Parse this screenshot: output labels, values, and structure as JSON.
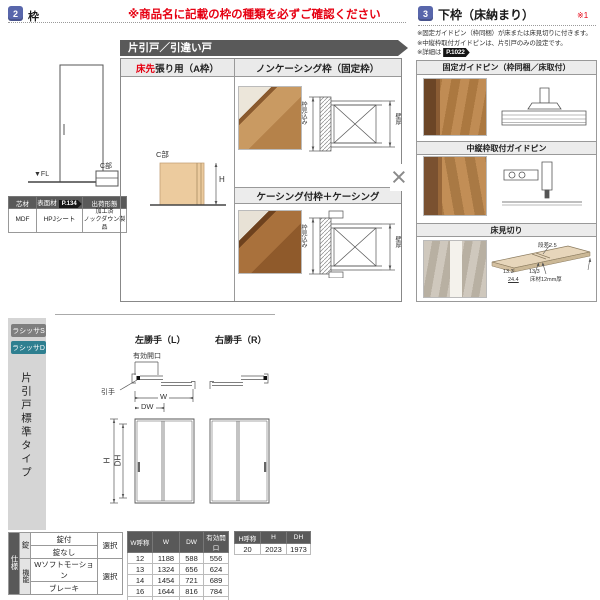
{
  "colors": {
    "accent_blue": "#5866ab",
    "alert_red": "#e60012",
    "teal_tab": "#2e7f90",
    "dark_gray": "#595959"
  },
  "frame_section": {
    "badge": "2",
    "title": "枠",
    "warning": "※商品名に記載の枠の種類を必ずご確認ください",
    "fl": "▼FL",
    "c_part": "C部",
    "material_table": {
      "headers": [
        "芯材",
        "表面材",
        "出荷形態"
      ],
      "page_badge": "P.134",
      "values": [
        "MDF",
        "HPJシート",
        "加工済\nノックダウン製品"
      ]
    },
    "door_types_banner": "片引戸／引違い戸",
    "floor_first_red": "床先",
    "floor_first_rest": "張り用（A枠）",
    "noncasing_header": "ノンケーシング枠（固定枠）",
    "casing_header": "ケーシング付枠＋ケーシング",
    "h_dim": "H",
    "frame_depth_dim": "枠見込み",
    "wall_thickness_dim": "壁厚",
    "times_mark": "×"
  },
  "bottom_rail_section": {
    "badge": "3",
    "title": "下枠（床納まり）",
    "ref_mark": "※1",
    "notes": [
      "※固定ガイドピン（枠同梱）が床または床見切りに付きます。",
      "※中縦枠取付ガイドピンは、片引戸のみの設定です。",
      "※詳細は"
    ],
    "page_badge": "P.1022",
    "fixed_pin_header": "固定ガイドピン（枠同梱／床取付）",
    "mid_frame_pin_header": "中縦枠取付ガイドピン",
    "floor_edge_header": "床見切り",
    "floor_edge_dims": {
      "step": "段差2.5",
      "left": "13.3",
      "right": "13.3",
      "total": "24.4",
      "material": "床材12mm厚"
    }
  },
  "product_section": {
    "tabs": [
      {
        "label": "ラシッサS",
        "active": false
      },
      {
        "label": "ラシッサD",
        "active": true
      }
    ],
    "side_label": "片引戸標準タイプ",
    "left_hand_label": "左勝手（L）",
    "right_hand_label": "右勝手（R）",
    "effective_opening_label": "有効開口",
    "handle_label": "引手",
    "w_label": "W",
    "dw_label": "DW",
    "h_label": "H",
    "dh_label": "DH",
    "spec_table": {
      "row_header": "仕様",
      "groups": [
        {
          "label": "錠",
          "options": [
            "錠付",
            "錠なし"
          ],
          "select": "選択"
        },
        {
          "label": "機能",
          "options": [
            "Wソフトモーション",
            "ブレーキ"
          ],
          "select": "選択"
        }
      ]
    },
    "w_table": {
      "headers": [
        "W呼称",
        "W",
        "DW",
        "有効開口"
      ],
      "rows": [
        [
          "12",
          "1188",
          "588",
          "556"
        ],
        [
          "13",
          "1324",
          "656",
          "624"
        ],
        [
          "14",
          "1454",
          "721",
          "689"
        ],
        [
          "16",
          "1644",
          "816",
          "784"
        ],
        [
          "18",
          "1824",
          "906",
          "874"
        ]
      ]
    },
    "h_table": {
      "headers": [
        "H呼称",
        "H",
        "DH"
      ],
      "rows": [
        [
          "20",
          "2023",
          "1973"
        ]
      ]
    }
  }
}
